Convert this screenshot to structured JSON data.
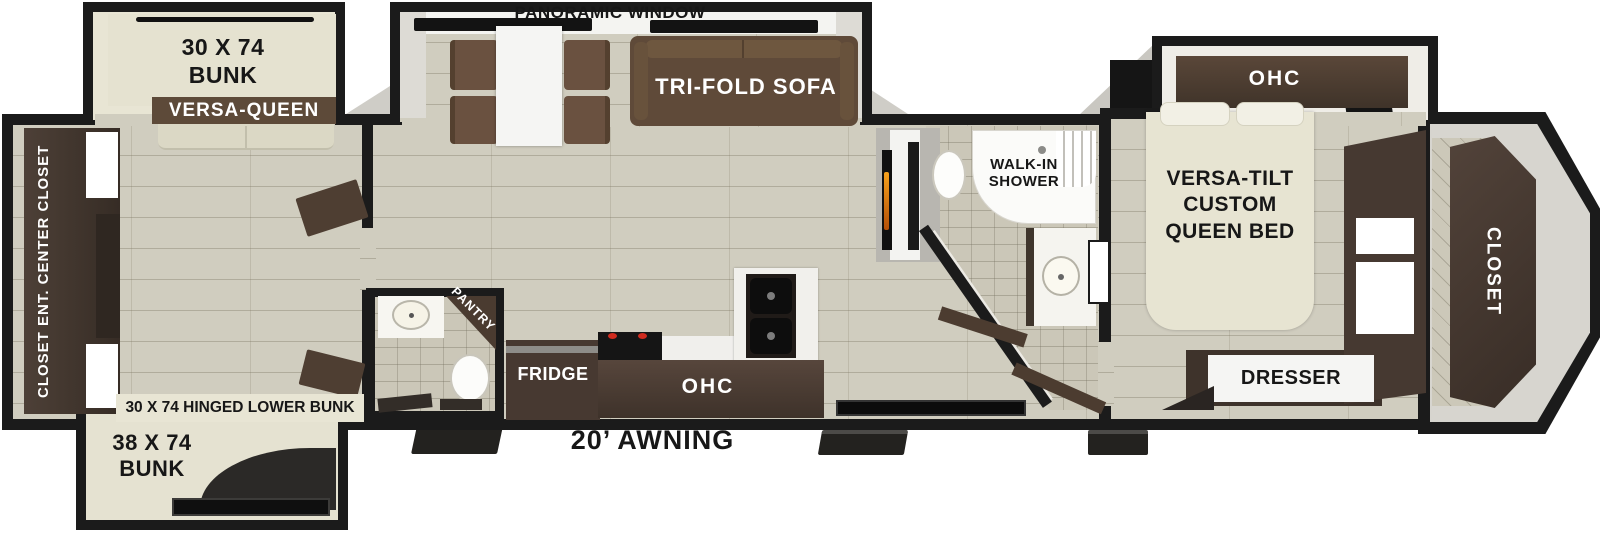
{
  "plan": {
    "panoramic_window": "PANORAMIC WINDOW",
    "awning": "20’ AWNING"
  },
  "bunkhouse": {
    "top_bunk_size": "30 X 74\nBUNK",
    "versa_queen": "VERSA-QUEEN",
    "closet_wall": "CLOSET  ENT. CENTER  CLOSET",
    "hinged_lower_bunk": "30 X 74 HINGED LOWER BUNK",
    "lower_bunk_size": "38 X 74\nBUNK"
  },
  "living": {
    "sofa": "TRI-FOLD SOFA"
  },
  "kitchen": {
    "pantry": "PANTRY",
    "fridge": "FRIDGE",
    "overhead_cabinet": "OHC"
  },
  "bathroom": {
    "walk_in_shower": "WALK-IN\nSHOWER"
  },
  "bedroom": {
    "overhead_cabinet": "OHC",
    "bed": "VERSA-TILT\nCUSTOM\nQUEEN BED",
    "dresser": "DRESSER",
    "front_closet": "CLOSET"
  },
  "colors": {
    "wall": "#1b1b1b",
    "wood_floor": "#d0cdbf",
    "cabinet_brown": "#473931",
    "accent_brown": "#5f4a39",
    "beige": "#e6e3d2",
    "flame_orange": "#f7a21c"
  }
}
